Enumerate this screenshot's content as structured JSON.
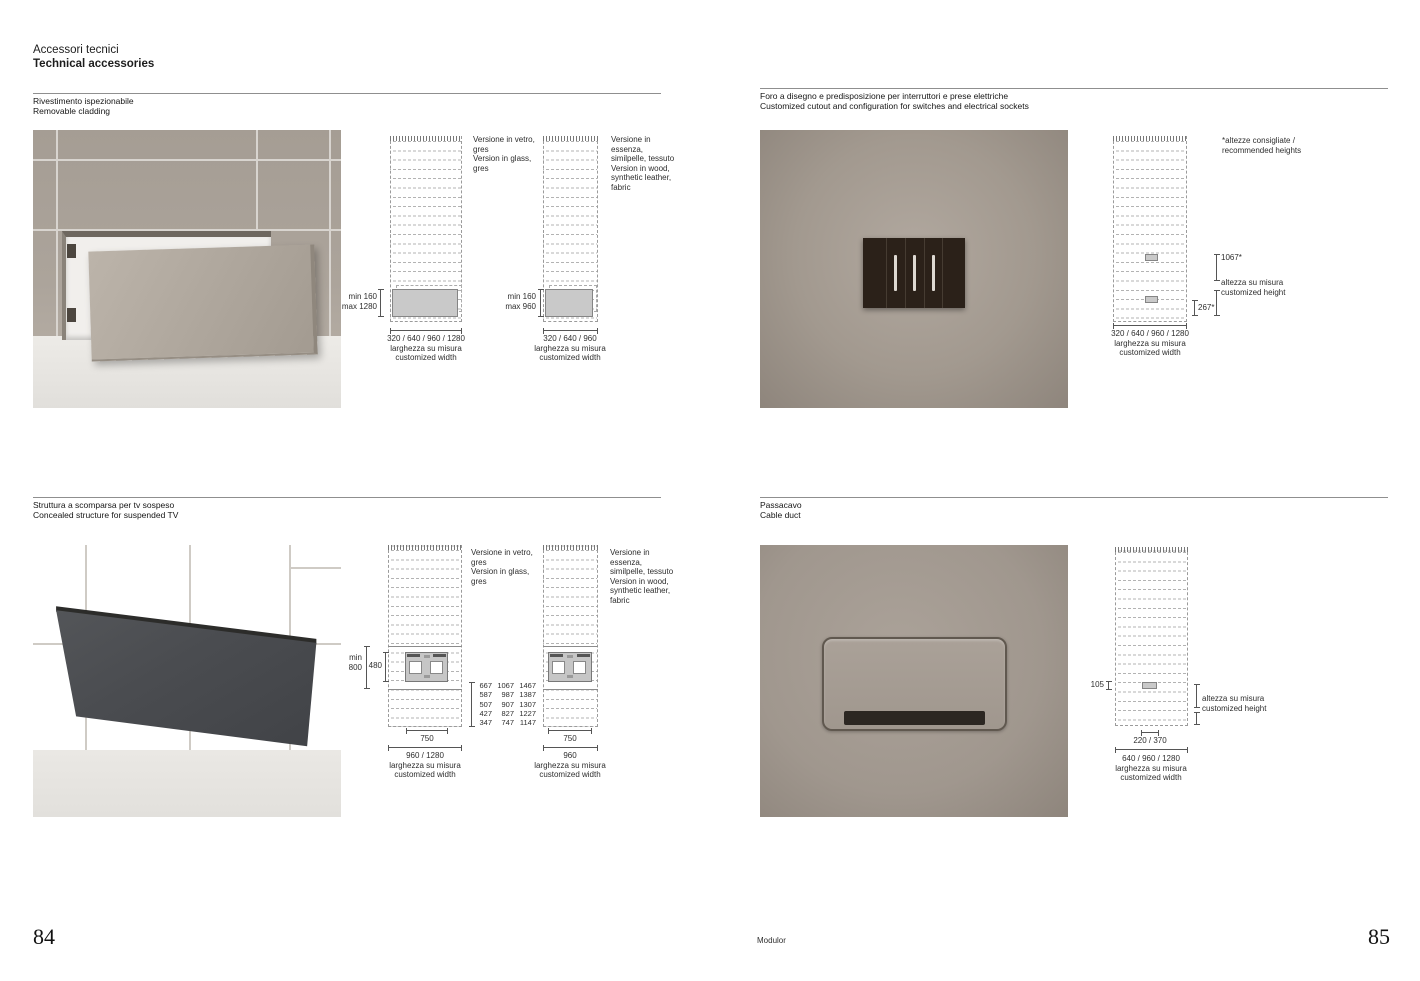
{
  "page": {
    "title_it": "Accessori tecnici",
    "title_en": "Technical accessories",
    "brand": "Modulor",
    "page_left": "84",
    "page_right": "85"
  },
  "labels": {
    "width_it": "larghezza su misura",
    "width_en": "customized width",
    "height_note": [
      "altezza su misura",
      "customized height"
    ]
  },
  "notes": {
    "glass": [
      "Versione in vetro,",
      "gres",
      "Version in glass,",
      "gres"
    ],
    "wood": [
      "Versione in essenza,",
      "similpelle, tessuto",
      "Version in wood,",
      "synthetic leather,",
      "fabric"
    ],
    "recommended": [
      "*altezze consigliate /",
      "recommended heights"
    ]
  },
  "sections": {
    "cladding": {
      "title_it": "Rivestimento ispezionabile",
      "title_en": "Removable cladding",
      "d1": {
        "box_dim": [
          "min 160",
          "max 1280"
        ],
        "widths": "320 / 640 / 960 / 1280"
      },
      "d2": {
        "box_dim": [
          "min 160",
          "max 960"
        ],
        "widths": "320 / 640 / 960"
      }
    },
    "switches": {
      "title_it": "Foro a disegno e predisposizione per interruttori e prese elettriche",
      "title_en": "Customized cutout and configuration for switches and electrical sockets",
      "dim_top": "1067*",
      "dim_bottom": "267*",
      "widths": "320 / 640 / 960 / 1280"
    },
    "tv": {
      "title_it": "Struttura a scomparsa per tv sospeso",
      "title_en": "Concealed structure for suspended TV",
      "d1": {
        "min_dim": [
          "min",
          "800"
        ],
        "bracket": "480",
        "inner_width": "750",
        "widths": "960 / 1280",
        "height_table": [
          [
            "667",
            "587",
            "507",
            "427",
            "347"
          ],
          [
            "1067",
            "987",
            "907",
            "827",
            "747"
          ],
          [
            "1467",
            "1387",
            "1307",
            "1227",
            "1147"
          ]
        ]
      },
      "d2": {
        "inner_width": "750",
        "widths": "960"
      }
    },
    "duct": {
      "title_it": "Passacavo",
      "title_en": "Cable duct",
      "dim_top": "105",
      "duct_widths": "220 / 370",
      "widths": "640 / 960 / 1280"
    }
  }
}
